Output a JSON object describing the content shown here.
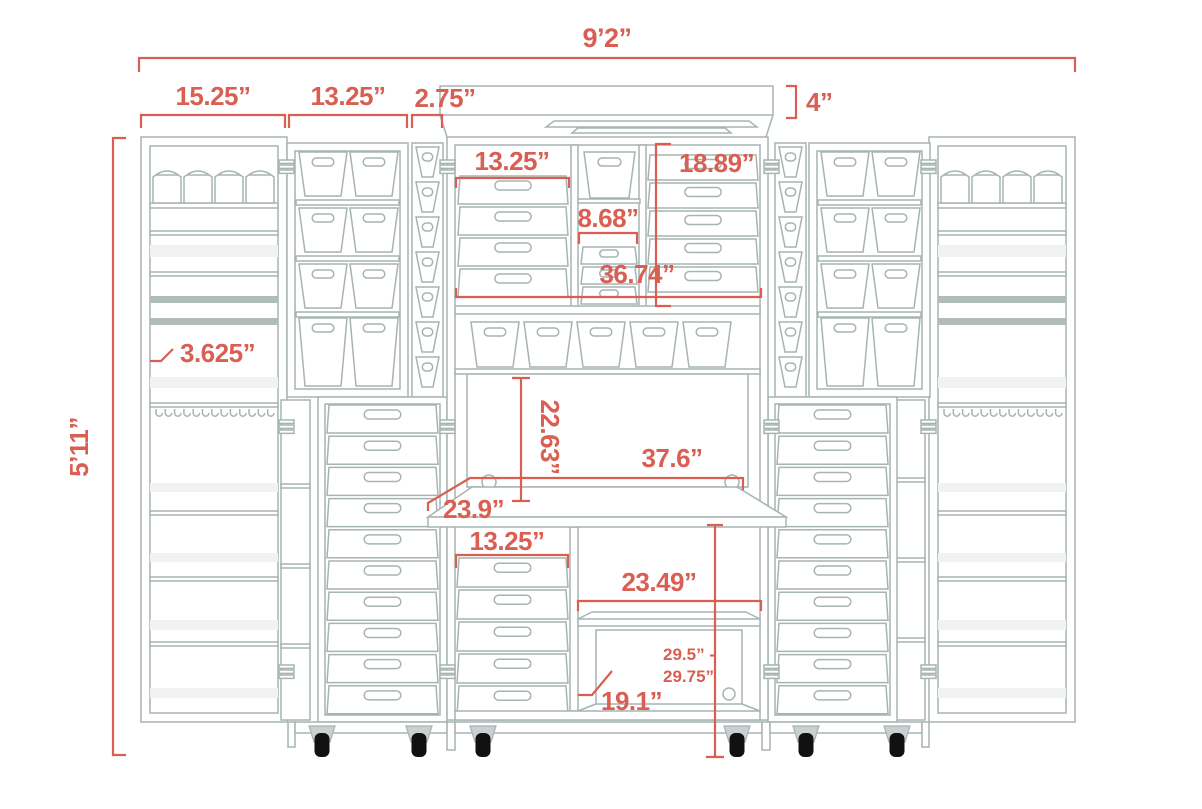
{
  "annotations": {
    "overall_width": "9’2”",
    "left_tower_width": "15.25”",
    "left_bin_column_width": "13.25”",
    "narrow_column_width": "2.75”",
    "crown_height": "4”",
    "overall_height": "5’11”",
    "shelf_lip_depth": "3.625”",
    "upper_drawer_width": "13.25”",
    "upper_column_height": "18.89”",
    "center_cubby_width": "8.68”",
    "upper_section_width": "36.74”",
    "desk_back_height": "22.63”",
    "desk_width": "37.6”",
    "desk_depth": "23.9”",
    "lower_drawer_width": "13.25”",
    "lower_cubby_width": "23.49”",
    "lower_shelf_depth": "19.1”",
    "desk_height_range_line1": "29.5” -",
    "desk_height_range_line2": "29.75”"
  },
  "colors": {
    "annotation": "#D95F52",
    "outline": "#A6B4B2",
    "shelf_light": "#F1F3F2",
    "shelf_dark": "#AFBCBA",
    "caster_fork": "#C9D1D0",
    "wheel": "#111111",
    "background": "#FFFFFF"
  }
}
